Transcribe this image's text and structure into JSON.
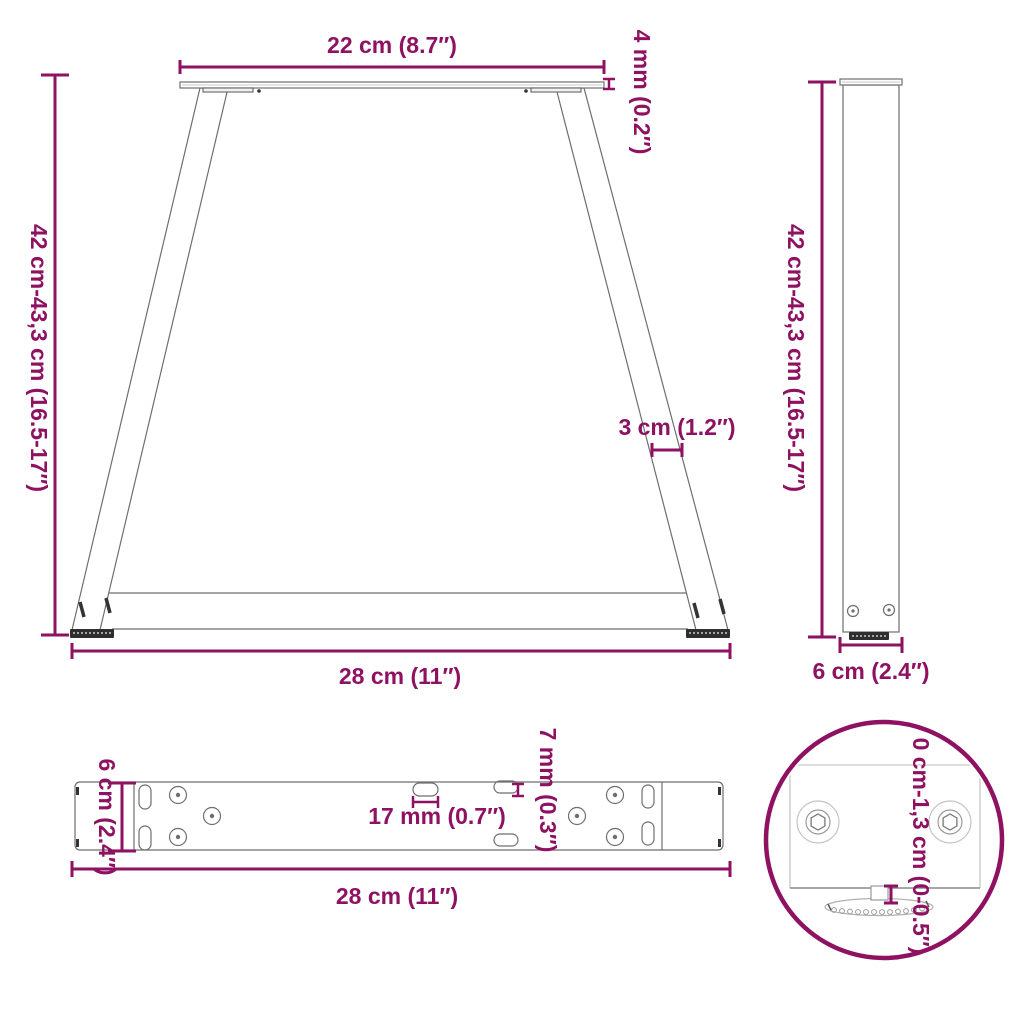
{
  "image_type": "furniture-leg dimension diagram",
  "colors": {
    "dimension_accent": "#8E1162",
    "drawing_line": "#6e6e6e",
    "foot_dark": "#2e2e2e",
    "background": "#ffffff"
  },
  "front_view": {
    "top_width_label": "22 cm (8.7″)",
    "plate_thickness_label": "4 mm (0.2″)",
    "height_label": "42 cm-43,3 cm (16.5-17″)",
    "profile_width_label": "3 cm (1.2″)",
    "bottom_width_label": "28 cm (11″)"
  },
  "side_view": {
    "height_label": "42 cm-43,3 cm (16.5-17″)",
    "depth_label": "6 cm (2.4″)"
  },
  "top_view": {
    "depth_label": "6 cm (2.4″)",
    "slot_length_label": "17 mm (0.7″)",
    "slot_width_label": "7 mm (0.3″)",
    "width_label": "28 cm (11″)"
  },
  "detail_view": {
    "height_adjustment_label": "0 cm-1,3 cm (0-0.5″)"
  }
}
